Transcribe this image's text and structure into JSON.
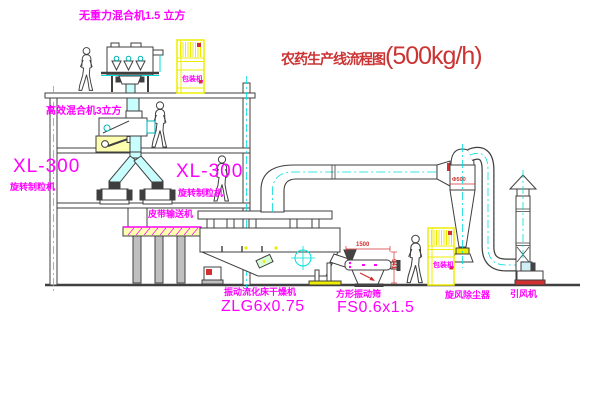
{
  "title": {
    "text": "农药生产线流程图",
    "capacity": "(500kg/h)"
  },
  "equipment_labels": {
    "gravity_free_mixer": "无重力混合机1.5 立方",
    "high_efficiency_mixer": "高效混合机3立方",
    "granulator_left_model": "XL-300",
    "granulator_left_name": "旋转制粒机",
    "granulator_right_model": "XL-300",
    "granulator_right_name": "旋转制粒机",
    "belt_conveyor": "皮带输送机",
    "fluid_bed_dryer_name": "振动流化床干燥机",
    "fluid_bed_dryer_model": "ZLG6x0.75",
    "vibrating_screen_name": "方形振动筛",
    "vibrating_screen_model": "FS0.6x1.5",
    "cyclone": "旋风除尘器",
    "induced_draft_fan": "引风机",
    "packing_machine_top": "包装机",
    "packing_machine_bottom": "包装机"
  },
  "dimension_annotations": {
    "screen_length": "1500",
    "screen_height": "941",
    "cyclone_marking": "Φ500"
  },
  "colors": {
    "label_magenta": "#ff00ff",
    "title_red": "#cc3333",
    "line_dark": "#3f3f3f",
    "cad_yellow": "#eded00",
    "cad_cyan": "#00dede",
    "duct_fill": "#c9feff"
  }
}
